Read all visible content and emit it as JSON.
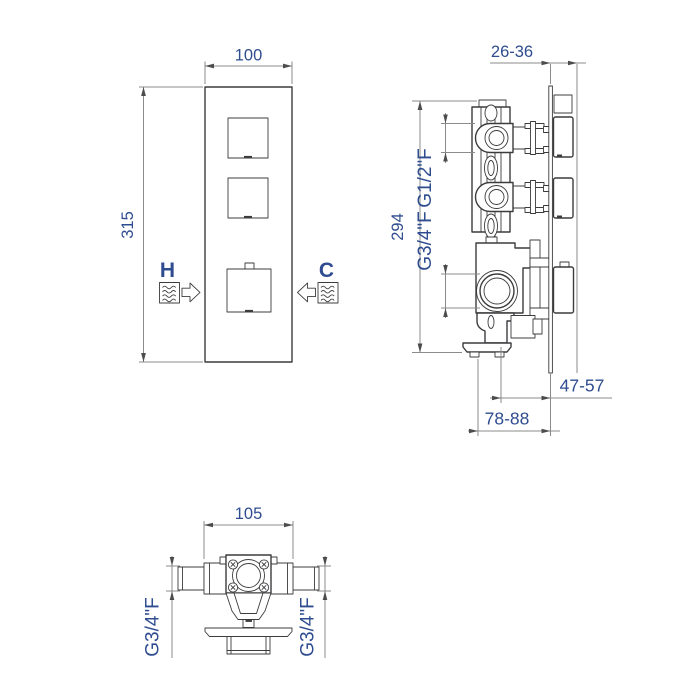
{
  "colors": {
    "background": "#ffffff",
    "outline": "#3c3c3e",
    "dimension_lines": "#8b8b8b",
    "arrowheads": "#4c4c4e",
    "label_text": "#2e4c8f"
  },
  "front_view": {
    "dim_width": "100",
    "dim_height": "315",
    "hot_label": "H",
    "cold_label": "C"
  },
  "side_view": {
    "dim_depth_range": "26-36",
    "dim_height": "294",
    "top_port_size": "G1/2\"F",
    "bottom_port_size": "G3/4\"F",
    "dim_center_to_wall": "47-57",
    "dim_body_depth": "78-88"
  },
  "bottom_view": {
    "dim_width": "105",
    "left_port_size": "G3/4\"F",
    "right_port_size": "G3/4\"F"
  },
  "icons": {
    "hot_water": "water-waves-icon",
    "hot_flow": "arrow-right-icon",
    "cold_water": "water-waves-icon",
    "cold_flow": "arrow-left-icon"
  }
}
